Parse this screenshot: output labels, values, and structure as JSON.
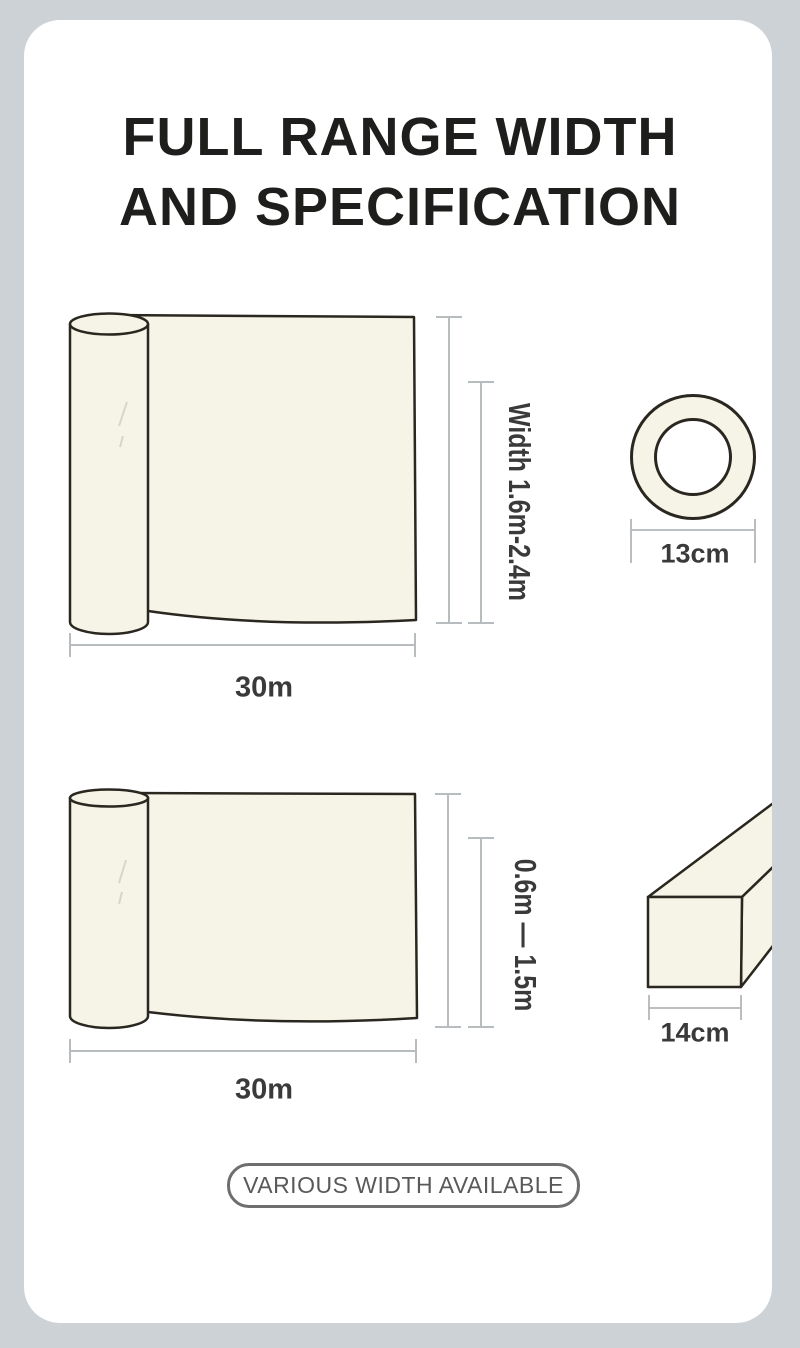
{
  "title": {
    "line1": "FULL RANGE WIDTH",
    "line2": "AND SPECIFICATION"
  },
  "roll1": {
    "width_label": "Width 1.6m-2.4m",
    "length_label": "30m",
    "core_diameter_label": "13cm"
  },
  "roll2": {
    "width_label": "0.6m — 1.5m",
    "length_label": "30m",
    "core_width_label": "14cm"
  },
  "badge": {
    "label": "VARIOUS WIDTH AVAILABLE"
  },
  "colors": {
    "background": "#ccd2d5",
    "card": "#ffffff",
    "material_fill": "#f6f4e7",
    "outline": "#29271f",
    "dimension_line": "#b7bcbe",
    "bracket_line": "#b2b7ba",
    "label_text": "#3a3a3a",
    "title_text": "#1e1e1c",
    "badge_border": "#6e6e6e",
    "badge_text": "#595959"
  }
}
